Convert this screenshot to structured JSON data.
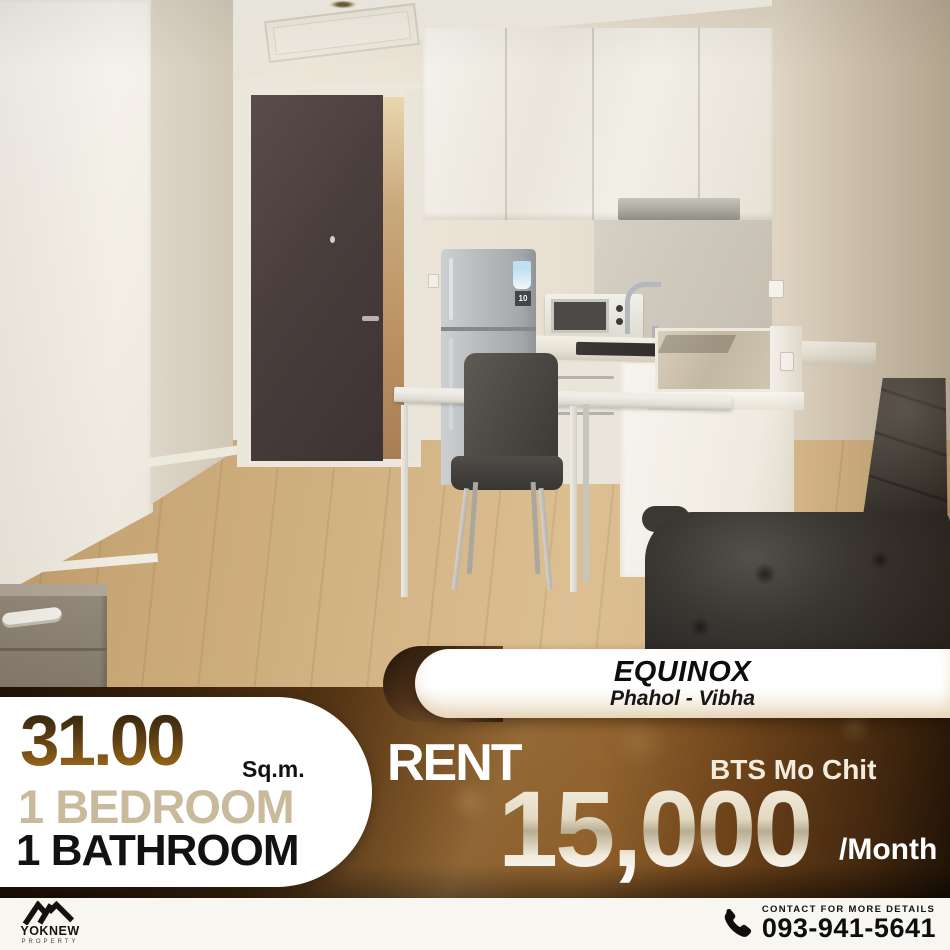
{
  "palette": {
    "band_brown_dark": "#2a1a0b",
    "band_brown_light": "#8a5a26",
    "area_text_brown": "#5c3d14",
    "bedroom_beige": "#c9ba9b",
    "price_cream": "#e3d9c2",
    "panel_white": "#ffffff"
  },
  "photo": {
    "description": "Condo room interior: dark entrance door, white kitchenette with refrigerator, microwave and hob, small white dining table with grey chair, black leather sofa, light wooden floor",
    "fridge_label": "10"
  },
  "project": {
    "name": "EQUINOX",
    "location": "Phahol - Vibha"
  },
  "specs": {
    "area_value": "31.00",
    "area_unit": "Sq.m.",
    "bedroom": "1 BEDROOM",
    "bathroom": "1 BATHROOM"
  },
  "pricing": {
    "label": "RENT",
    "station": "BTS Mo Chit",
    "amount": "15,000",
    "period": "/Month"
  },
  "brand": {
    "name": "YOKNEW",
    "subtitle": "PROPERTY"
  },
  "contact": {
    "label": "CONTACT FOR MORE DETAILS",
    "phone": "093-941-5641"
  }
}
